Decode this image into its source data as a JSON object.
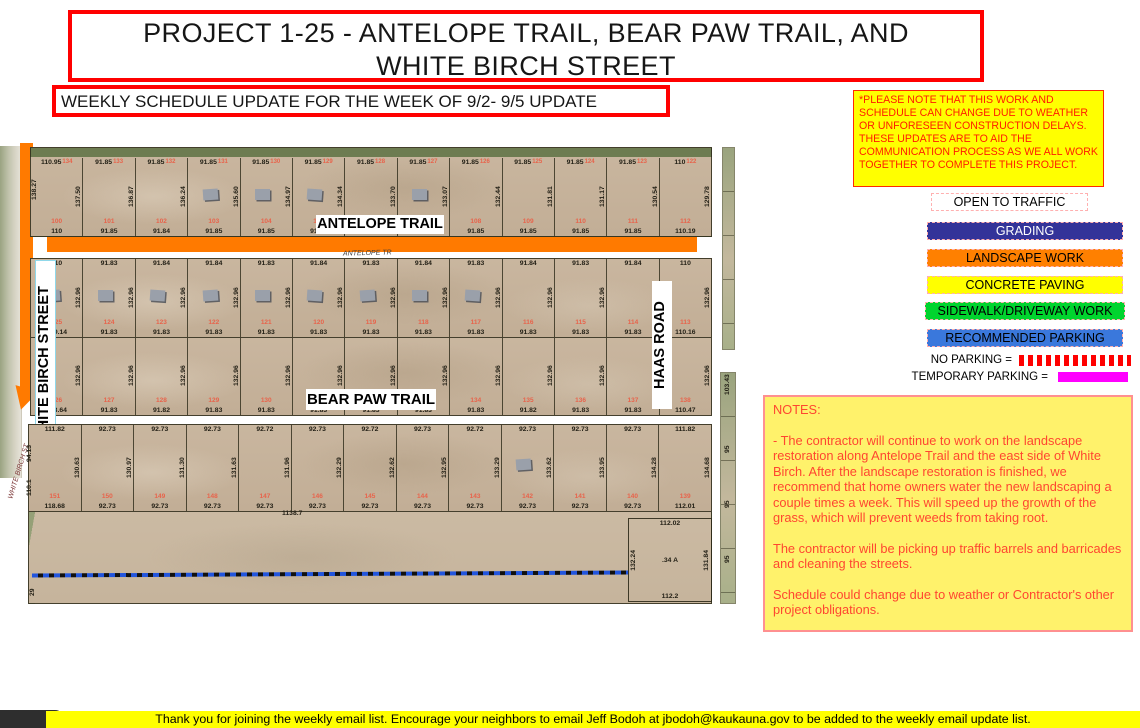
{
  "title": {
    "line1": "PROJECT 1-25 - ANTELOPE TRAIL, BEAR PAW TRAIL, AND",
    "line2": "WHITE BIRCH STREET"
  },
  "subtitle": "WEEKLY SCHEDULE UPDATE FOR THE WEEK OF 9/2- 9/5 UPDATE",
  "disclaimer": "*PLEASE NOTE THAT THIS WORK AND SCHEDULE CAN CHANGE DUE TO WEATHER OR UNFORESEEN CONSTRUCTION DELAYS. THESE UPDATES ARE TO AID THE COMMUNICATION PROCESS AS WE ALL WORK TOGETHER TO COMPLETE THIS PROJECT.",
  "legend": {
    "items": [
      {
        "label": "OPEN TO TRAFFIC",
        "color": "#FFFFFF",
        "text_color": "#000000"
      },
      {
        "label": "GRADING",
        "color": "#333399",
        "text_color": "#FFFFFF"
      },
      {
        "label": "LANDSCAPE WORK",
        "color": "#FF8000",
        "text_color": "#000000"
      },
      {
        "label": "CONCRETE PAVING",
        "color": "#FFFF00",
        "text_color": "#000000"
      },
      {
        "label": "SIDEWALK/DRIVEWAY WORK",
        "color": "#00D42E",
        "text_color": "#000000"
      },
      {
        "label": "RECOMMENDED PARKING",
        "color": "#3A78DC",
        "text_color": "#000000"
      }
    ],
    "no_parking_label": "NO PARKING =",
    "no_parking_color": "#FF0000",
    "temporary_parking_label": "TEMPORARY PARKING =",
    "temporary_parking_color": "#FF00FF"
  },
  "notes": {
    "heading": "NOTES:",
    "text_color": "#FF4630",
    "bg_color": "#FFF26B",
    "paragraphs": [
      "- The contractor will continue to work on the landscape restoration along Antelope Trail and the east side of White Birch. After the landscape restoration is finished, we recommend that home owners water the new landscaping a couple times a week. This will speed up the growth of the grass, which will prevent weeds from taking root.",
      "The contractor will be picking up traffic barrels and barricades and cleaning the streets.",
      "Schedule could change due to weather or Contractor's other project obligations."
    ]
  },
  "footer": "Thank you for joining the weekly email list. Encourage your neighbors to email Jeff Bodoh at jbodoh@kaukauna.gov to be added to the weekly email update list.",
  "map": {
    "labels": {
      "antelope_trail": "ANTELOPE TRAIL",
      "antelope_tr": "ANTELOPE TR",
      "bear_paw_trail": "BEAR PAW TRAIL",
      "white_birch_street": "WHITE BIRCH STREET",
      "white_birch_st": "WHITE BIRCH ST",
      "haas_road": "HAAS ROAD",
      "boundary_length": "1138.7",
      "west_dim_a": "94.13",
      "west_dim_b": "110.1",
      "west_dim_c": "29",
      "east_strip_dim": "103.43"
    },
    "north_row": {
      "west_depth": "138.27",
      "top_edge": [
        "110.95",
        "91.85",
        "91.85",
        "91.85",
        "91.85",
        "91.85",
        "91.85",
        "91.85",
        "91.85",
        "91.85",
        "91.85",
        "91.85",
        "110"
      ],
      "outer_lot_numbers": [
        "134",
        "133",
        "132",
        "131",
        "130",
        "129",
        "128",
        "127",
        "126",
        "125",
        "124",
        "123",
        "122"
      ],
      "depths": [
        "137.50",
        "136.87",
        "136.24",
        "135.60",
        "134.97",
        "134.34",
        "133.70",
        "133.07",
        "132.44",
        "131.81",
        "131.17",
        "130.54",
        "129.78"
      ],
      "lot_numbers": [
        "100",
        "101",
        "102",
        "103",
        "104",
        "105",
        "106",
        "107",
        "108",
        "109",
        "110",
        "111",
        "112"
      ],
      "bottom_edge": [
        "110",
        "91.85",
        "91.84",
        "91.85",
        "91.85",
        "91.85",
        "91.84",
        "91.84",
        "91.85",
        "91.85",
        "91.85",
        "91.85",
        "110.19"
      ],
      "houses": [
        3,
        4,
        5,
        7
      ]
    },
    "mid_north": {
      "top_edge": [
        "110",
        "91.83",
        "91.84",
        "91.84",
        "91.83",
        "91.84",
        "91.83",
        "91.84",
        "91.83",
        "91.84",
        "91.83",
        "91.84",
        "110"
      ],
      "depths": [
        "132.96",
        "132.96",
        "132.96",
        "132.96",
        "132.96",
        "132.96",
        "132.96",
        "132.96",
        "132.96",
        "132.96",
        "132.96",
        "132.96",
        "132.96"
      ],
      "lot_numbers": [
        "125",
        "124",
        "123",
        "122",
        "121",
        "120",
        "119",
        "118",
        "117",
        "116",
        "115",
        "114",
        "113"
      ],
      "bottom_edge": [
        "109.14",
        "91.83",
        "91.83",
        "91.83",
        "91.83",
        "91.83",
        "91.83",
        "91.83",
        "91.83",
        "91.83",
        "91.83",
        "91.83",
        "110.16"
      ],
      "houses": [
        0,
        1,
        2,
        3,
        4,
        5,
        6,
        7,
        8
      ]
    },
    "mid_south": {
      "depths": [
        "132.96",
        "132.96",
        "132.96",
        "132.96",
        "132.96",
        "132.96",
        "132.96",
        "132.96",
        "132.96",
        "132.96",
        "132.96",
        "132.96",
        "132.96"
      ],
      "lot_numbers": [
        "126",
        "127",
        "128",
        "129",
        "130",
        "131",
        "132",
        "133",
        "134",
        "135",
        "136",
        "137",
        "138"
      ],
      "bottom_edge": [
        "118.64",
        "91.83",
        "91.82",
        "91.83",
        "91.83",
        "91.83",
        "91.83",
        "91.83",
        "91.83",
        "91.82",
        "91.83",
        "91.83",
        "110.47"
      ],
      "houses": []
    },
    "south_row": {
      "top_edge": [
        "111.82",
        "92.73",
        "92.73",
        "92.73",
        "92.72",
        "92.73",
        "92.72",
        "92.73",
        "92.72",
        "92.73",
        "92.73",
        "92.73",
        "111.82"
      ],
      "depths": [
        "130.63",
        "130.97",
        "131.30",
        "131.63",
        "131.96",
        "132.29",
        "132.62",
        "132.95",
        "133.29",
        "133.62",
        "133.95",
        "134.28",
        "134.68"
      ],
      "lot_numbers": [
        "151",
        "150",
        "149",
        "148",
        "147",
        "146",
        "145",
        "144",
        "143",
        "142",
        "141",
        "140",
        "139"
      ],
      "bottom_edge": [
        "118.68",
        "92.73",
        "92.73",
        "92.73",
        "92.73",
        "92.73",
        "92.73",
        "92.73",
        "92.73",
        "92.73",
        "92.73",
        "92.73",
        "112.01"
      ],
      "houses": [
        9
      ]
    },
    "se_parcel": {
      "top": "112.02",
      "left": "132.24",
      "right": "131.84",
      "area": ".34 A",
      "bottom": "112.2"
    },
    "east_strip_ticks": [
      "95",
      "95",
      "95"
    ]
  }
}
